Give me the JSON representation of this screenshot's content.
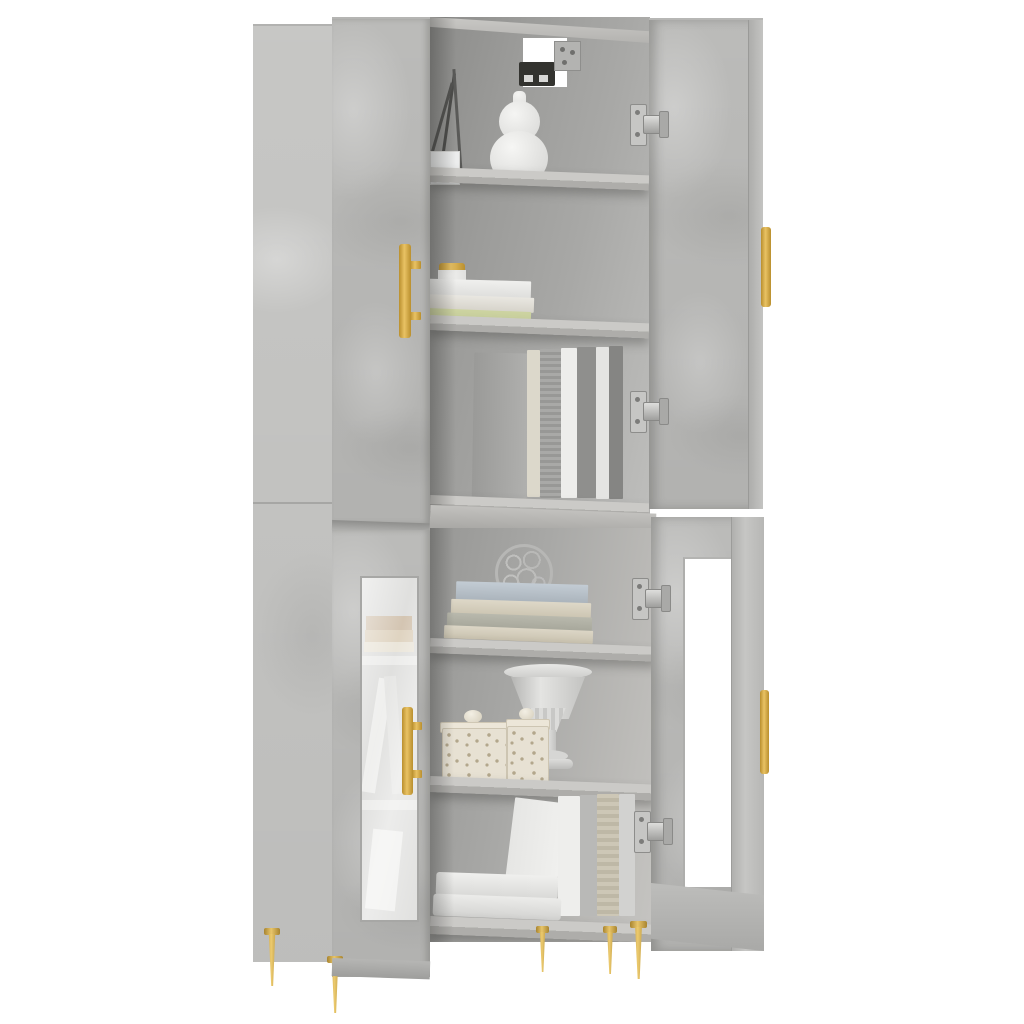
{
  "meta": {
    "image_type": "product-photo",
    "caption": "Tall concrete-grey highboard storage cabinet on gold pin legs, two upper doors and two lower glass doors open, shelves styled with books, white gourd vase, twig branches, wire sphere ornament, carved trinket boxes and a white pedestal urn, on a plain white background",
    "background_color": "#ffffff"
  },
  "palette": {
    "background": "#ffffff",
    "concrete": "#bfbfbd",
    "concrete_light": "#c9c9c7",
    "concrete_dark": "#a3a3a1",
    "seam": "#8f8f8d",
    "interior_dark": "#8c8c8a",
    "interior_mid": "#a8a8a6",
    "interior_light": "#bebebc",
    "shelf_top": "#cbcac7",
    "shelf_edge": "#aeadaa",
    "gold": "#e9c264",
    "gold_dark": "#b98f2e",
    "hinge_silver": "#c6c6c4",
    "glass_white": "#ffffff",
    "book_white": "#ebebe9",
    "book_cream": "#dcd5c4",
    "book_green": "#ccd3a0",
    "book_bluegrey": "#b9c2ca",
    "book_grey": "#9d9d9b",
    "ceramic_white": "#e9e9e7"
  },
  "furniture": {
    "type_label": "highboard cabinet",
    "finish_label": "concrete grey",
    "handle_label": "brass bar handle",
    "leg_label": "tapered brass pin leg",
    "doors": [
      {
        "id": "upper-left",
        "state": "closed",
        "panel": "solid"
      },
      {
        "id": "upper-right",
        "state": "open",
        "panel": "solid"
      },
      {
        "id": "lower-left",
        "state": "closed",
        "panel": "glass"
      },
      {
        "id": "lower-right",
        "state": "open",
        "panel": "glass"
      }
    ]
  },
  "objects": [
    {
      "id": "twig-branches",
      "label": "dark decorative twigs in corner vase"
    },
    {
      "id": "gourd-vase",
      "label": "white double-gourd ceramic vase"
    },
    {
      "id": "storage-box-small",
      "label": "small white box on top shelf"
    },
    {
      "id": "cable-hole",
      "label": "square cable cutout with metal wall bracket"
    },
    {
      "id": "lidded-jar",
      "label": "white jar with brass lid on book stack"
    },
    {
      "id": "book-stack-upper",
      "label": "two white books and one green book stacked flat"
    },
    {
      "id": "standing-books-upper",
      "label": "row of grey and white books standing upright"
    },
    {
      "id": "wire-sphere-ornament",
      "label": "silver wire sphere ornament"
    },
    {
      "id": "flat-book-stack",
      "label": "stack of blue-grey and cream books lying flat"
    },
    {
      "id": "pedestal-urn",
      "label": "white fluted pedestal urn"
    },
    {
      "id": "carved-box-large",
      "label": "large carved cream trinket box with knob lid"
    },
    {
      "id": "carved-box-small",
      "label": "small carved cream trinket box with knob lid"
    },
    {
      "id": "standing-books-lower",
      "label": "white and grey books standing upright"
    },
    {
      "id": "book-stack-bottom",
      "label": "two thick white books stacked flat"
    },
    {
      "id": "glass-door-books",
      "label": "books seen hazily through left glass door"
    }
  ]
}
